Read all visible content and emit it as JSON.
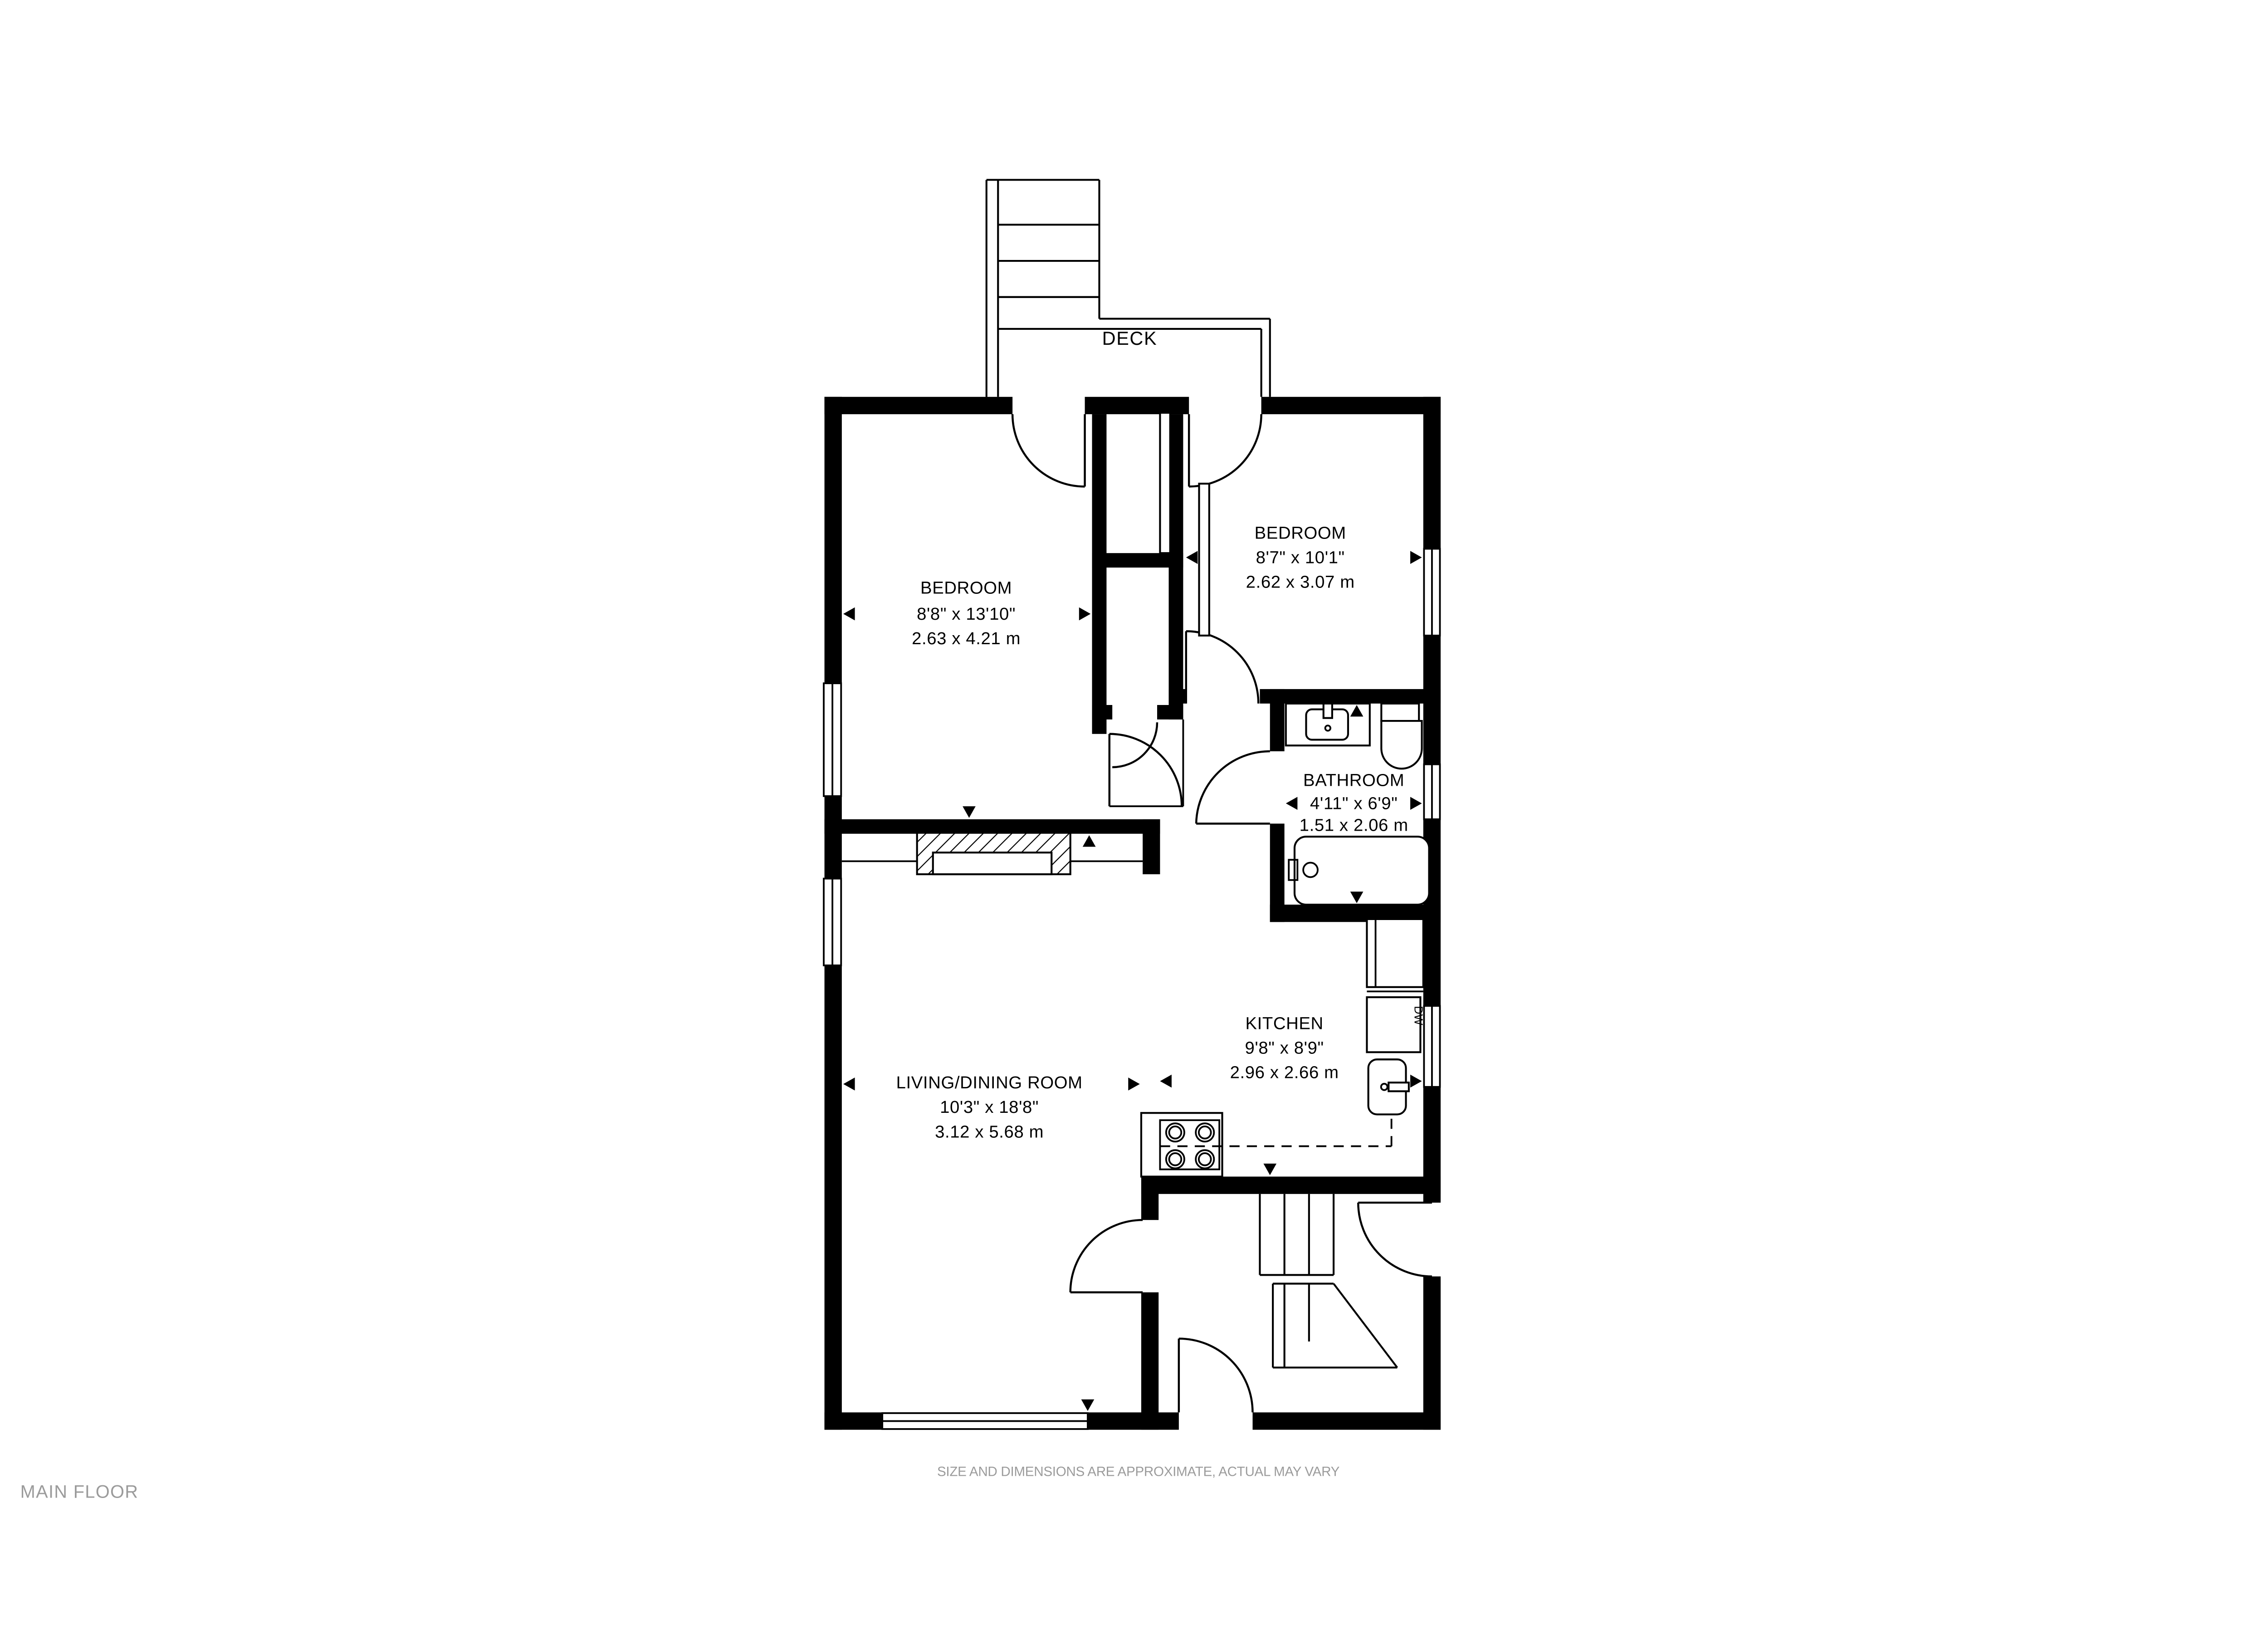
{
  "footer": {
    "title": "MAIN FLOOR",
    "disclaimer": "SIZE AND DIMENSIONS ARE APPROXIMATE, ACTUAL MAY VARY"
  },
  "deck": {
    "label": "DECK"
  },
  "rooms": [
    {
      "id": "bedroom-left",
      "name": "BEDROOM",
      "dims_imperial": "8'8\" x 13'10\"",
      "dims_metric": "2.63 x 4.21 m"
    },
    {
      "id": "bedroom-right",
      "name": "BEDROOM",
      "dims_imperial": "8'7\" x 10'1\"",
      "dims_metric": "2.62 x 3.07 m"
    },
    {
      "id": "bathroom",
      "name": "BATHROOM",
      "dims_imperial": "4'11\" x 6'9\"",
      "dims_metric": "1.51 x 2.06 m"
    },
    {
      "id": "kitchen",
      "name": "KITCHEN",
      "dims_imperial": "9'8\" x 8'9\"",
      "dims_metric": "2.96 x 2.66 m"
    },
    {
      "id": "living-dining",
      "name": "LIVING/DINING ROOM",
      "dims_imperial": "10'3\" x 18'8\"",
      "dims_metric": "3.12 x 5.68 m"
    }
  ],
  "appliances": {
    "dishwasher_label": "DW"
  },
  "colors": {
    "wall": "#000000",
    "muted_text": "#9b9b9b",
    "background": "#ffffff"
  }
}
